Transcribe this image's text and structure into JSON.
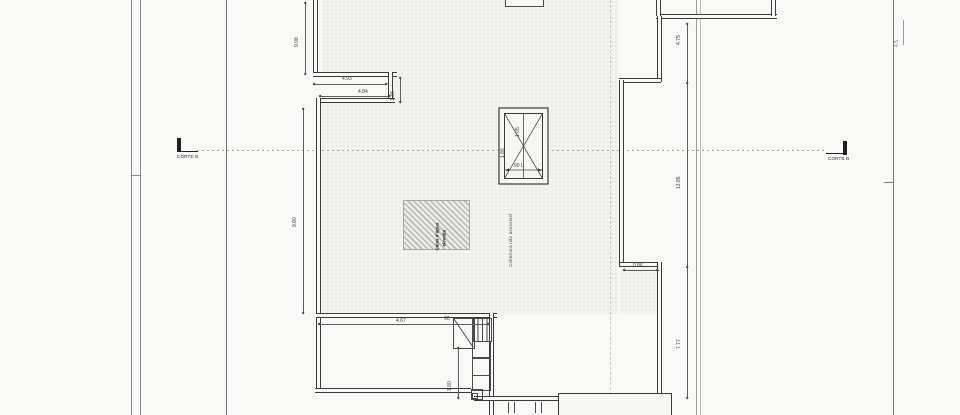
{
  "drawing": {
    "section_marker_left": "CORTE B",
    "section_marker_right": "CORTE B",
    "labels": {
      "roof_area": "Cobertura não acessível",
      "water_tank_line1": "Caixa d'água",
      "water_tank_line2": "elevada"
    },
    "dimensions": {
      "left_upper": "9.08",
      "left_lower": "9.80",
      "notch_width_top": "4.93",
      "notch_width_bottom": "4.84",
      "notch_depth": "1.36",
      "right_top": "4.75",
      "right_middle": "13.85",
      "right_bottom": "7.77",
      "step_width": "0.86",
      "terrace_width": "4.67",
      "stair_width": "90",
      "stair_height": "1.80",
      "far_right": "4.5",
      "skylight_width": "1.05",
      "skylight_height": "1.86",
      "skylight_base": "90 L"
    },
    "colors": {
      "wall_line": "#3a3a3a",
      "paper": "#f8f8f6",
      "hatch": "#b9b9b3"
    }
  }
}
